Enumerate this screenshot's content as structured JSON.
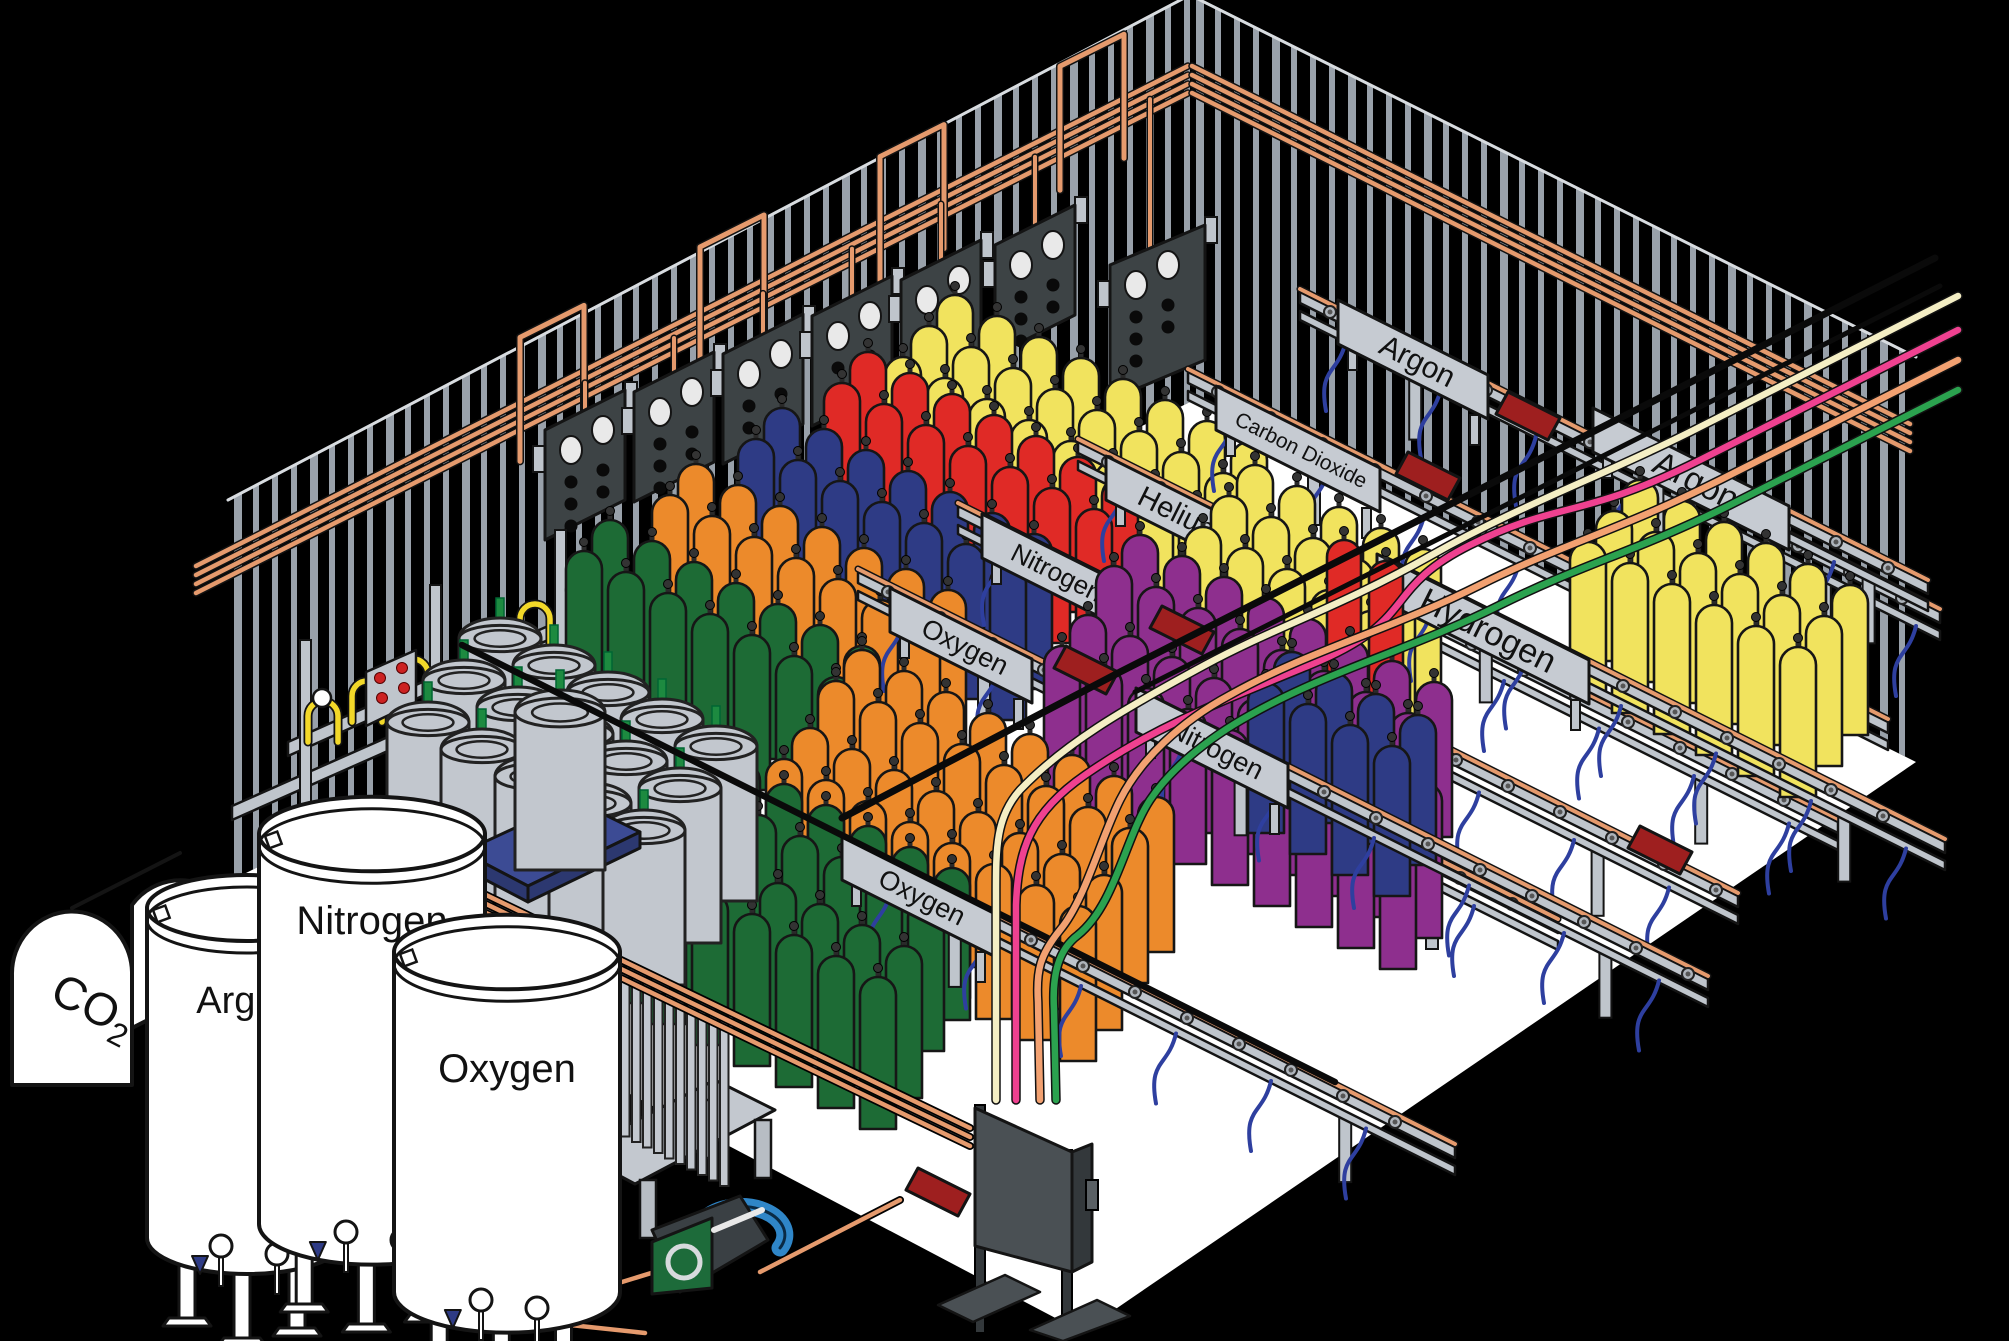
{
  "scene": {
    "description": "Isometric cutaway of a gas cylinder filling plant",
    "colors": {
      "background": "#000000",
      "floor": "#ffffff",
      "wall_stripe": "#99a1aa",
      "steel": "#bfc5cc",
      "steel_dark": "#3d4345",
      "copper": "#e59a6d",
      "hose_blue": "#2e3f9f",
      "pallet_blue": "#3c4b94",
      "tray_red": "#9e1f1f",
      "valve_green": "#1d8a40",
      "pigtail_yellow": "#f2d829",
      "compressor_green": "#1d6b3a",
      "compressor_blue": "#2f86c8",
      "outline": "#141414",
      "text": "#111111"
    }
  },
  "signs": [
    {
      "id": "argon-top",
      "label": "Argon",
      "x": 1338,
      "y": 300,
      "w": 150,
      "fs": 30
    },
    {
      "id": "carbon-dioxide",
      "label": "Carbon Dioxide",
      "x": 1216,
      "y": 386,
      "w": 164,
      "fs": 21
    },
    {
      "id": "helium",
      "label": "Helium",
      "x": 1106,
      "y": 456,
      "w": 140,
      "fs": 29
    },
    {
      "id": "nitrogen-left",
      "label": "Nitrogen",
      "x": 982,
      "y": 514,
      "w": 142,
      "fs": 26
    },
    {
      "id": "oxygen-upper",
      "label": "Oxygen",
      "x": 890,
      "y": 588,
      "w": 142,
      "fs": 27
    },
    {
      "id": "argon-right",
      "label": "Argon",
      "x": 1593,
      "y": 408,
      "w": 196,
      "fs": 34
    },
    {
      "id": "hydrogen",
      "label": "Hydrogen",
      "x": 1377,
      "y": 554,
      "w": 212,
      "fs": 34
    },
    {
      "id": "nitrogen-right",
      "label": "Nitrogen",
      "x": 1136,
      "y": 688,
      "w": 152,
      "fs": 27
    },
    {
      "id": "oxygen-lower",
      "label": "Oxygen",
      "x": 842,
      "y": 836,
      "w": 152,
      "fs": 27
    }
  ],
  "tanks": [
    {
      "id": "co2-bulk-tank",
      "label": "CO2",
      "type": "horizontal"
    },
    {
      "id": "argon-bulk-tank",
      "label": "Argon",
      "cx": 247,
      "top": 908,
      "r": 100,
      "h": 330,
      "label_dy": 105,
      "fs": 38
    },
    {
      "id": "nitrogen-bulk-tank",
      "label": "Nitrogen",
      "cx": 372,
      "top": 834,
      "r": 113,
      "h": 390,
      "label_dy": 100,
      "fs": 40
    },
    {
      "id": "oxygen-bulk-tank",
      "label": "Oxygen",
      "cx": 507,
      "top": 952,
      "r": 113,
      "h": 340,
      "label_dy": 130,
      "fs": 40
    }
  ],
  "rails": [
    {
      "id": "argon-top",
      "x": 1300,
      "y": 292,
      "len": 640
    },
    {
      "id": "carbon-dioxide",
      "x": 1188,
      "y": 372,
      "len": 700
    },
    {
      "id": "helium",
      "x": 1078,
      "y": 442,
      "len": 760
    },
    {
      "id": "nitrogen-left",
      "x": 958,
      "y": 506,
      "len": 780
    },
    {
      "id": "oxygen-upper",
      "x": 858,
      "y": 572,
      "len": 700
    },
    {
      "id": "argon-right",
      "x": 1598,
      "y": 418,
      "len": 330
    },
    {
      "id": "hydrogen",
      "x": 1385,
      "y": 562,
      "len": 560
    },
    {
      "id": "nitrogen-right",
      "x": 1138,
      "y": 694,
      "len": 570
    },
    {
      "id": "oxygen-right",
      "x": 845,
      "y": 842,
      "len": 610
    }
  ],
  "cylinder_groups": [
    {
      "id": "argon-yellow-back",
      "color": "#f1e35e",
      "x": 955,
      "y": 295,
      "cols": 8,
      "rows": 3,
      "w": 36,
      "h": 150
    },
    {
      "id": "helium-red-back",
      "color": "#e02a26",
      "x": 868,
      "y": 352,
      "cols": 7,
      "rows": 2,
      "w": 36,
      "h": 155
    },
    {
      "id": "nitrogen-navy-back",
      "color": "#2e3b85",
      "x": 782,
      "y": 408,
      "cols": 7,
      "rows": 2,
      "w": 36,
      "h": 155
    },
    {
      "id": "nitrogen-orange-back",
      "color": "#ec8a2b",
      "x": 696,
      "y": 464,
      "cols": 7,
      "rows": 2,
      "w": 36,
      "h": 155
    },
    {
      "id": "oxygen-green-back",
      "color": "#1d6b35",
      "x": 610,
      "y": 520,
      "cols": 7,
      "rows": 2,
      "w": 36,
      "h": 155
    },
    {
      "id": "argon-right-yellow",
      "color": "#f1e35e",
      "x": 1640,
      "y": 480,
      "cols": 6,
      "rows": 3,
      "w": 36,
      "h": 150
    },
    {
      "id": "argon-mid-yellow",
      "color": "#f1e35e",
      "x": 1255,
      "y": 465,
      "cols": 5,
      "rows": 3,
      "w": 36,
      "h": 150
    },
    {
      "id": "helium-red-pair",
      "color": "#e02a26",
      "x": 1344,
      "y": 540,
      "cols": 2,
      "rows": 1,
      "w": 34,
      "h": 150
    },
    {
      "id": "hydrogen-purple-back",
      "color": "#8e2f8e",
      "x": 1140,
      "y": 535,
      "cols": 8,
      "rows": 2,
      "w": 36,
      "h": 155
    },
    {
      "id": "hydrogen-purple-front",
      "color": "#8e2f8e",
      "x": 1088,
      "y": 615,
      "cols": 9,
      "rows": 2,
      "w": 36,
      "h": 155
    },
    {
      "id": "navy-mid",
      "color": "#2e3b85",
      "x": 1292,
      "y": 652,
      "cols": 4,
      "rows": 2,
      "w": 36,
      "h": 150
    },
    {
      "id": "nitrogen-orange-big-a",
      "color": "#ec8a2b",
      "x": 862,
      "y": 650,
      "cols": 8,
      "rows": 2,
      "w": 36,
      "h": 155
    },
    {
      "id": "nitrogen-orange-big-b",
      "color": "#ec8a2b",
      "x": 810,
      "y": 728,
      "cols": 8,
      "rows": 2,
      "w": 36,
      "h": 155
    },
    {
      "id": "oxygen-green-big-a",
      "color": "#1d6b35",
      "x": 700,
      "y": 742,
      "cols": 7,
      "rows": 2,
      "w": 36,
      "h": 152
    },
    {
      "id": "oxygen-green-big-b",
      "color": "#1d6b35",
      "x": 652,
      "y": 820,
      "cols": 7,
      "rows": 2,
      "w": 36,
      "h": 152
    }
  ],
  "manifold_panels": [
    {
      "x": 545,
      "y": 390
    },
    {
      "x": 634,
      "y": 352
    },
    {
      "x": 723,
      "y": 314
    },
    {
      "x": 812,
      "y": 276
    },
    {
      "x": 901,
      "y": 240
    },
    {
      "x": 995,
      "y": 205
    },
    {
      "x": 1110,
      "y": 225
    }
  ],
  "trays": [
    {
      "x": 1508,
      "y": 392
    },
    {
      "x": 1408,
      "y": 452
    },
    {
      "x": 1162,
      "y": 606
    },
    {
      "x": 1066,
      "y": 646
    },
    {
      "x": 918,
      "y": 1168
    },
    {
      "x": 1640,
      "y": 826
    }
  ],
  "transfer_lines": [
    {
      "id": "cream-line",
      "color": "#f4eec4"
    },
    {
      "id": "pink-line",
      "color": "#ef4190"
    },
    {
      "id": "salmon-line",
      "color": "#f2a171"
    },
    {
      "id": "green-line",
      "color": "#2ba24f"
    }
  ]
}
